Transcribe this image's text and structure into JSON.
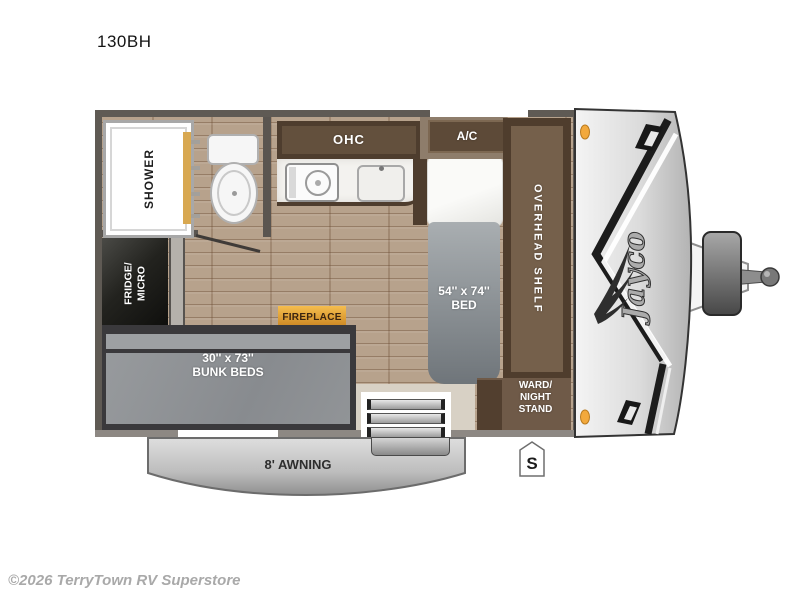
{
  "page": {
    "title": "130BH",
    "footer": "©2026 TerryTown RV Superstore"
  },
  "floorplan": {
    "brand": "Jayco",
    "badge": "S",
    "labels": {
      "shower": "SHOWER",
      "fridge_line1": "FRIDGE/",
      "fridge_line2": "MICRO",
      "ohc": "OHC",
      "ac": "A/C",
      "bed_line1": "54'' x 74''",
      "bed_line2": "BED",
      "overhead_shelf": "OVERHEAD SHELF",
      "ward_line1": "WARD/",
      "ward_line2": "NIGHT",
      "ward_line3": "STAND",
      "fireplace": "FIREPLACE",
      "bunk_line1": "30'' x 73''",
      "bunk_line2": "BUNK BEDS",
      "awning": "8' AWNING"
    },
    "colors": {
      "wall": "#5f5a54",
      "wood_floor": "#b7a28c",
      "cabinet_brown": "#5d4a38",
      "mattress_gray": "#8f9295",
      "fireplace_amber": "#e8a33d",
      "marker_light_amber": "#f2a93d",
      "front_cap_silver": "#d9d9d9"
    }
  }
}
